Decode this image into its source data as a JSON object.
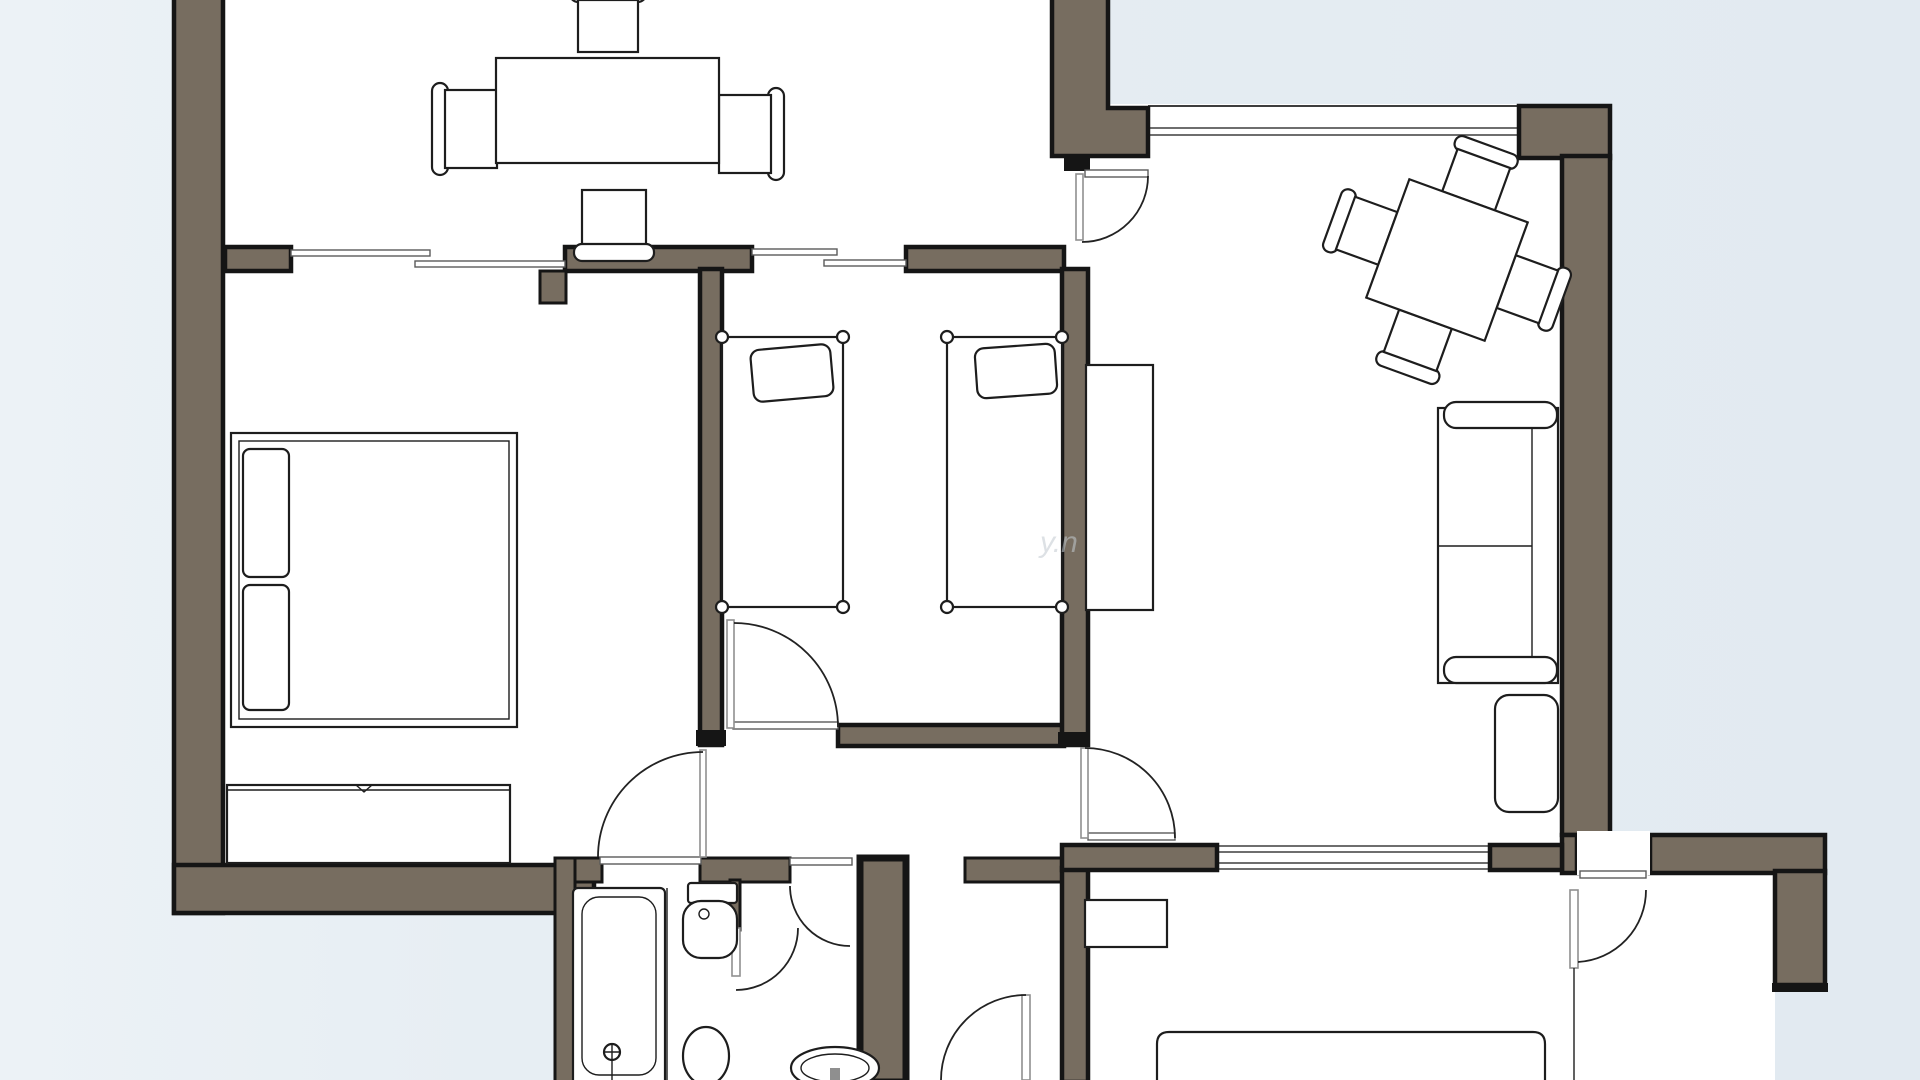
{
  "colors": {
    "wall": "#776d60",
    "wall_edge": "#151515",
    "line": "#1d1d1d",
    "background_outer": "#e9eff4",
    "background_outer2": "#e2eaf1",
    "interior": "#ffffff",
    "watermark": "#c3cad0"
  },
  "watermark": {
    "text": "y.n"
  },
  "plan": {
    "type": "apartment-floor-plan",
    "rooms": [
      {
        "name": "kitchen-dining",
        "furniture": [
          "dining-table",
          "chair x4"
        ]
      },
      {
        "name": "bedroom",
        "furniture": [
          "double-bed",
          "pillow x2",
          "dresser"
        ]
      },
      {
        "name": "children-room",
        "furniture": [
          "single-bed x2",
          "pillow x2"
        ]
      },
      {
        "name": "living-room",
        "furniture": [
          "square-table-rotated",
          "chair x4",
          "sofa",
          "ottoman",
          "cabinet"
        ]
      },
      {
        "name": "bathroom",
        "furniture": [
          "bathtub",
          "toilet",
          "pedestal-sink"
        ]
      },
      {
        "name": "wc",
        "furniture": [
          "round-basin"
        ]
      },
      {
        "name": "entry-lobby",
        "furniture": []
      },
      {
        "name": "back-room",
        "furniture": [
          "nightstand",
          "bed-partial"
        ]
      }
    ],
    "doors": 8,
    "windows": [
      "top-right-window",
      "living-back-window"
    ]
  }
}
